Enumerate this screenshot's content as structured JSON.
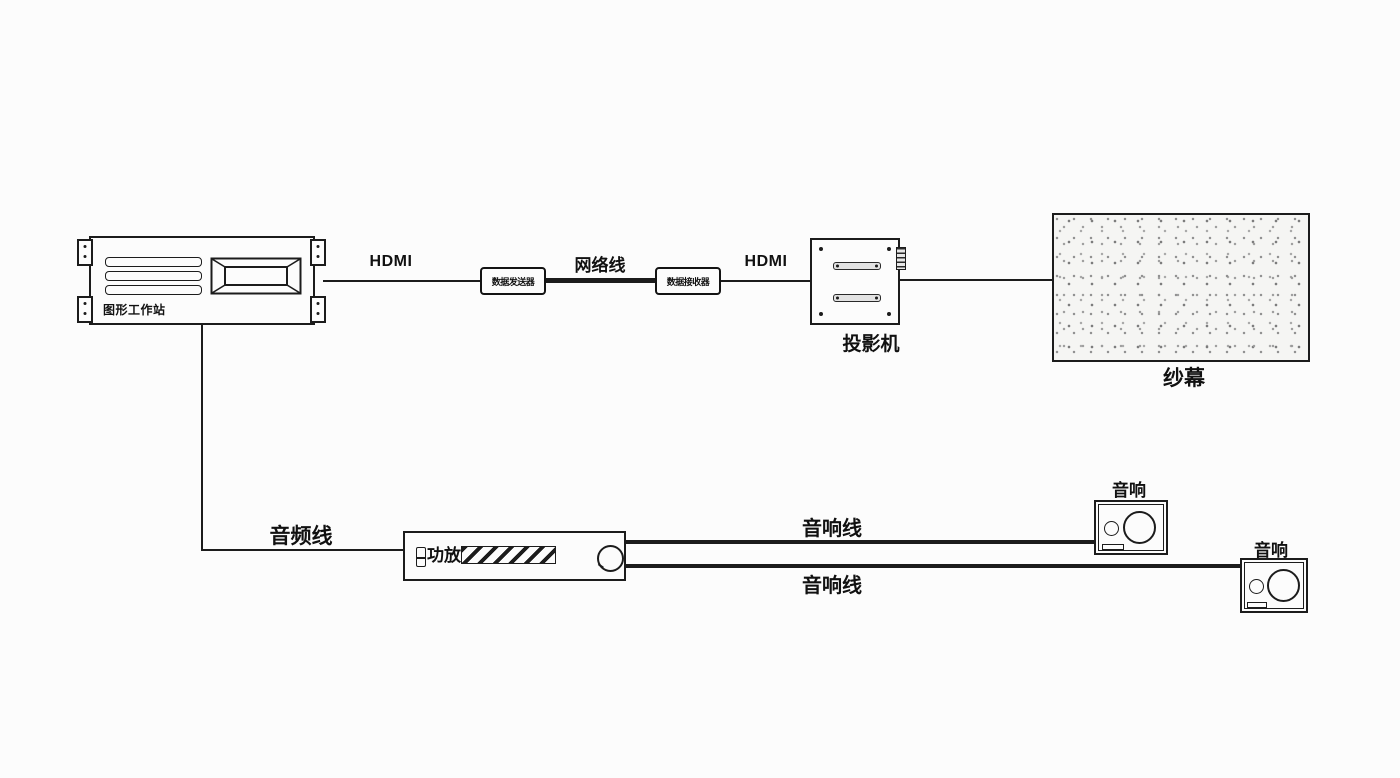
{
  "colors": {
    "background": "#fcfcfc",
    "line": "#1c1c1c"
  },
  "nodes": {
    "workstation": {
      "label": "图形工作站"
    },
    "transmitter": {
      "label": "数据发送器"
    },
    "receiver": {
      "label": "数据接收器"
    },
    "projector": {
      "label": "投影机"
    },
    "screen": {
      "label": "纱幕"
    },
    "amplifier": {
      "label": "功放"
    },
    "speaker_top": {
      "label": "音响"
    },
    "speaker_bottom": {
      "label": "音响"
    }
  },
  "cables": {
    "hdmi_1": {
      "label": "HDMI"
    },
    "network": {
      "label": "网络线"
    },
    "hdmi_2": {
      "label": "HDMI"
    },
    "audio": {
      "label": "音频线"
    },
    "speaker_line_top": {
      "label": "音响线"
    },
    "speaker_line_bottom": {
      "label": "音响线"
    }
  }
}
